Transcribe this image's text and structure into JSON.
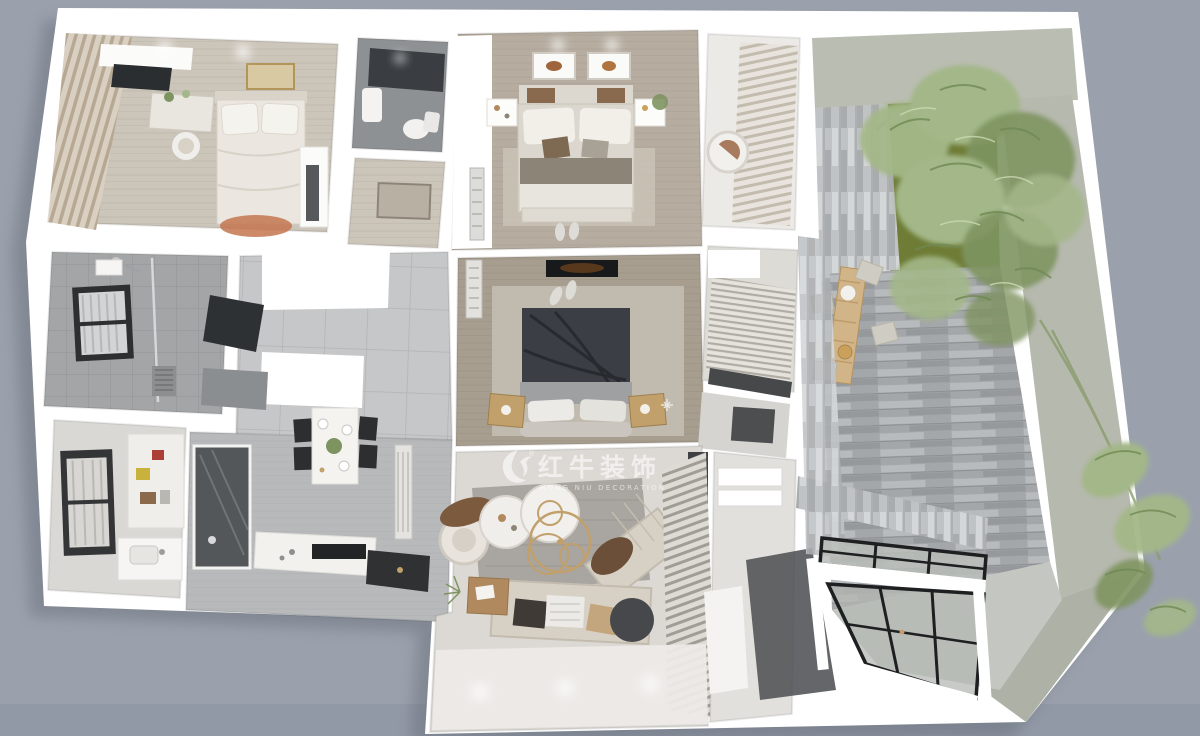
{
  "scene": {
    "type": "3d-rendered-floorplan-top-view",
    "description": "Top-down 3D rendering of a residential apartment with terrace garden",
    "background_color": "#9aa1ac",
    "wall_color": "#ffffff"
  },
  "watermark": {
    "logo": "bull-logo",
    "registered": "®",
    "brand_cn": "红牛装饰",
    "brand_en": "HONG NIU DECORATION"
  },
  "palette": {
    "bg": "#9aa1ac",
    "wall": "#ffffff",
    "concrete": "#b6b9ae",
    "grass": "#6e7c35",
    "plant_light": "#a3b788",
    "plant_dark": "#7e9460",
    "dark_panel": "#2e3134",
    "dark_bed": "#3b3e44",
    "gold": "#c2a06b",
    "sofa": "#d7d1c5",
    "terrace_plank": "#a4a7aa",
    "watermark_color": "#ffffff"
  },
  "regions": [
    {
      "id": "bedroom-1",
      "label": "bedroom with vanity and curtains"
    },
    {
      "id": "wc",
      "label": "small toilet room"
    },
    {
      "id": "corridor-top",
      "label": "corridor segment"
    },
    {
      "id": "master-bedroom",
      "label": "master bedroom with double bed"
    },
    {
      "id": "lounge-nook",
      "label": "reading nook with egg chair"
    },
    {
      "id": "terrace",
      "label": "terrace with plants, grass and outdoor table"
    },
    {
      "id": "bathroom-1",
      "label": "tiled bathroom with shower"
    },
    {
      "id": "entry-hall",
      "label": "entry hall with cabinets"
    },
    {
      "id": "bedroom-2",
      "label": "bedroom with dark bed"
    },
    {
      "id": "bathroom-2",
      "label": "bathroom with blinds and vanity"
    },
    {
      "id": "utility-room",
      "label": "utility room with shelves"
    },
    {
      "id": "kitchen-dining",
      "label": "kitchen and dining area"
    },
    {
      "id": "living-room",
      "label": "living room with sectional sofa"
    },
    {
      "id": "side-corridor",
      "label": "side corridor with steps"
    },
    {
      "id": "glass-skylight",
      "label": "black framed glass skylight structure"
    }
  ]
}
